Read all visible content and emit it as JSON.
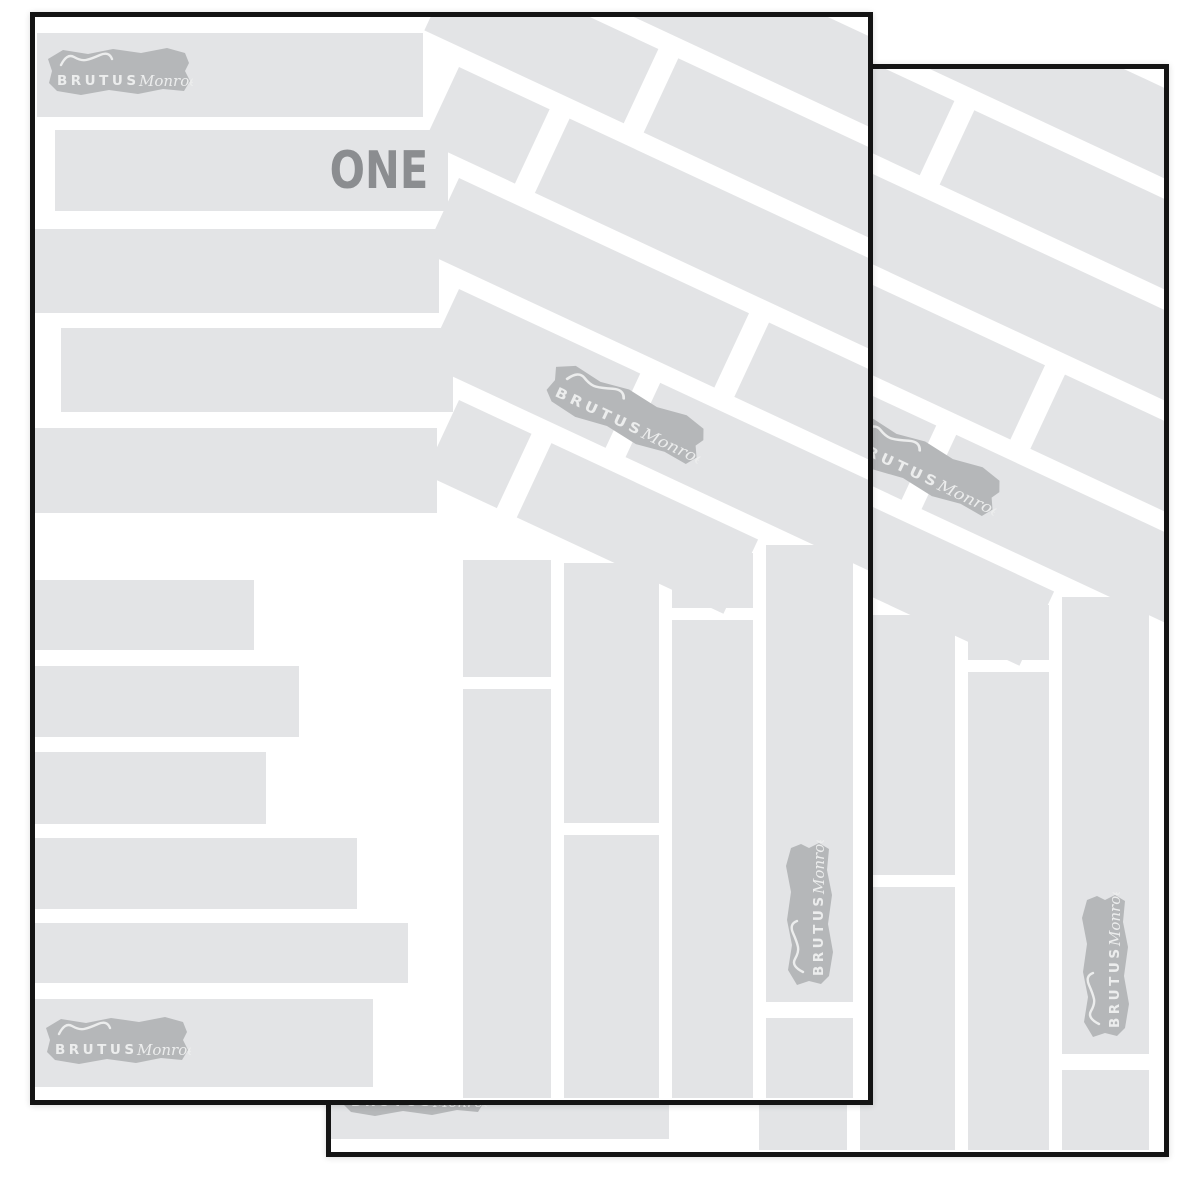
{
  "front_page": {
    "label": "ONE"
  },
  "brand": {
    "caps": "BRUTUS",
    "script": "Monroe"
  },
  "colors": {
    "paper_white": "#ffffff",
    "bar_gray": "#e3e4e6",
    "logo_gray": "#b5b7b9",
    "logo_text": "#eceded",
    "label_gray": "#8b8d90",
    "border_black": "#141414"
  }
}
